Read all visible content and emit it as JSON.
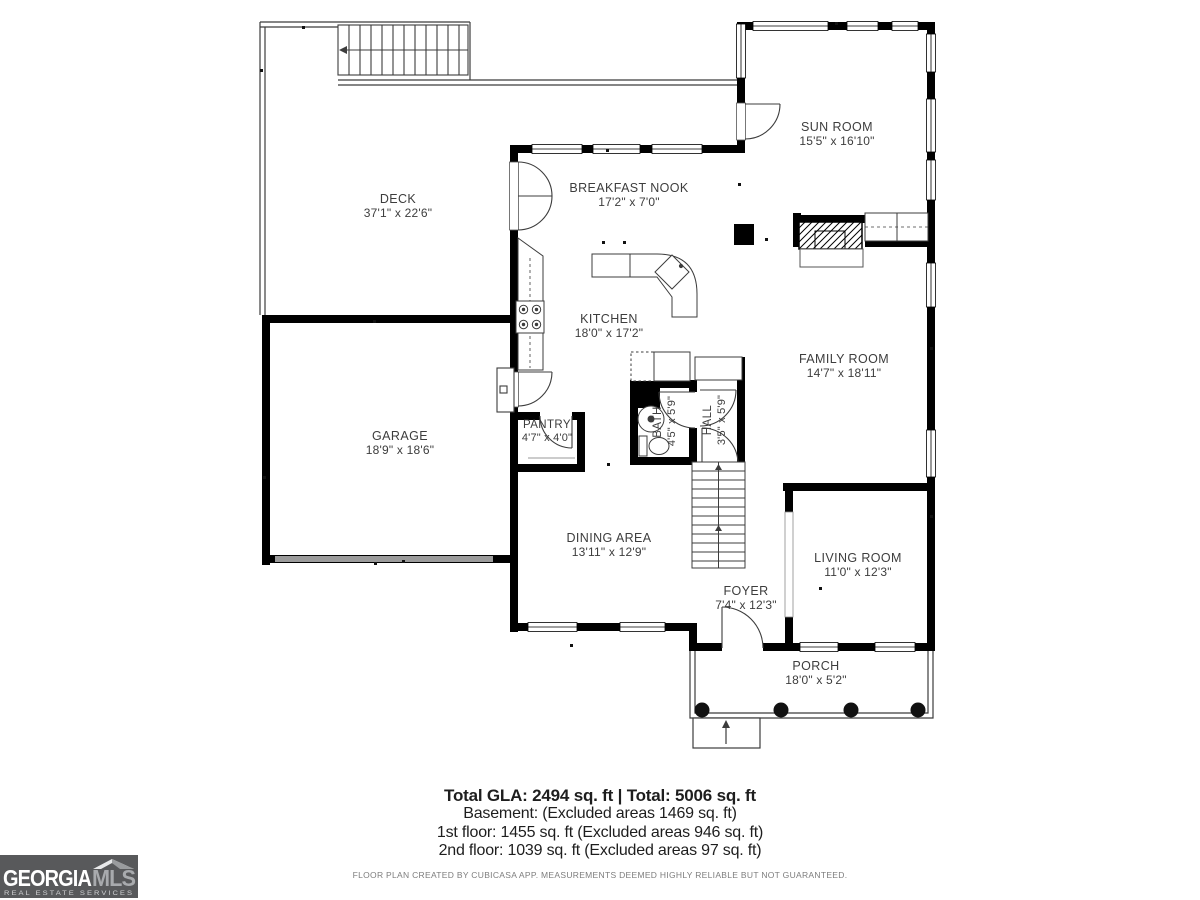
{
  "page": {
    "type": "real-estate floor plan",
    "floor": "1st floor"
  },
  "rooms": {
    "deck": {
      "name": "DECK",
      "dims": "37'1\" x 22'6\""
    },
    "sun_room": {
      "name": "SUN ROOM",
      "dims": "15'5\" x 16'10\""
    },
    "breakfast_nook": {
      "name": "BREAKFAST NOOK",
      "dims": "17'2\" x 7'0\""
    },
    "kitchen": {
      "name": "KITCHEN",
      "dims": "18'0\" x 17'2\""
    },
    "family_room": {
      "name": "FAMILY ROOM",
      "dims": "14'7\" x 18'11\""
    },
    "garage": {
      "name": "GARAGE",
      "dims": "18'9\" x 18'6\""
    },
    "pantry": {
      "name": "PANTRY",
      "dims": "4'7\" x 4'0\""
    },
    "bath": {
      "name": "BATH",
      "dims": "4'5\" x 5'9\""
    },
    "hall": {
      "name": "HALL",
      "dims": "3'5\" x 5'9\""
    },
    "dining_area": {
      "name": "DINING AREA",
      "dims": "13'11\" x 12'9\""
    },
    "living_room": {
      "name": "LIVING ROOM",
      "dims": "11'0\" x 12'3\""
    },
    "foyer": {
      "name": "FOYER",
      "dims": "7'4\" x 12'3\""
    },
    "porch": {
      "name": "PORCH",
      "dims": "18'0\" x 5'2\""
    }
  },
  "footer": {
    "total_line": "Total GLA: 2494 sq. ft | Total: 5006 sq. ft",
    "basement_line": "Basement: (Excluded areas 1469 sq. ft)",
    "first_floor_line": "1st floor: 1455 sq. ft (Excluded areas 946 sq. ft)",
    "second_floor_line": "2nd floor: 1039 sq. ft (Excluded areas 97 sq. ft)",
    "disclaimer": "FLOOR PLAN CREATED BY CUBICASA APP. MEASUREMENTS DEEMED HIGHLY RELIABLE BUT NOT GUARANTEED."
  },
  "logo": {
    "name": "GEORGIA",
    "suffix": "MLS",
    "tagline": "REAL ESTATE SERVICES"
  },
  "colors": {
    "wall": "#000000",
    "thin_line": "#3c3c3c",
    "label": "#3d3d3d",
    "garage_door": "#9b9b9b",
    "logo_bg": "#58595b",
    "logo_mls": "#a8aaad"
  }
}
